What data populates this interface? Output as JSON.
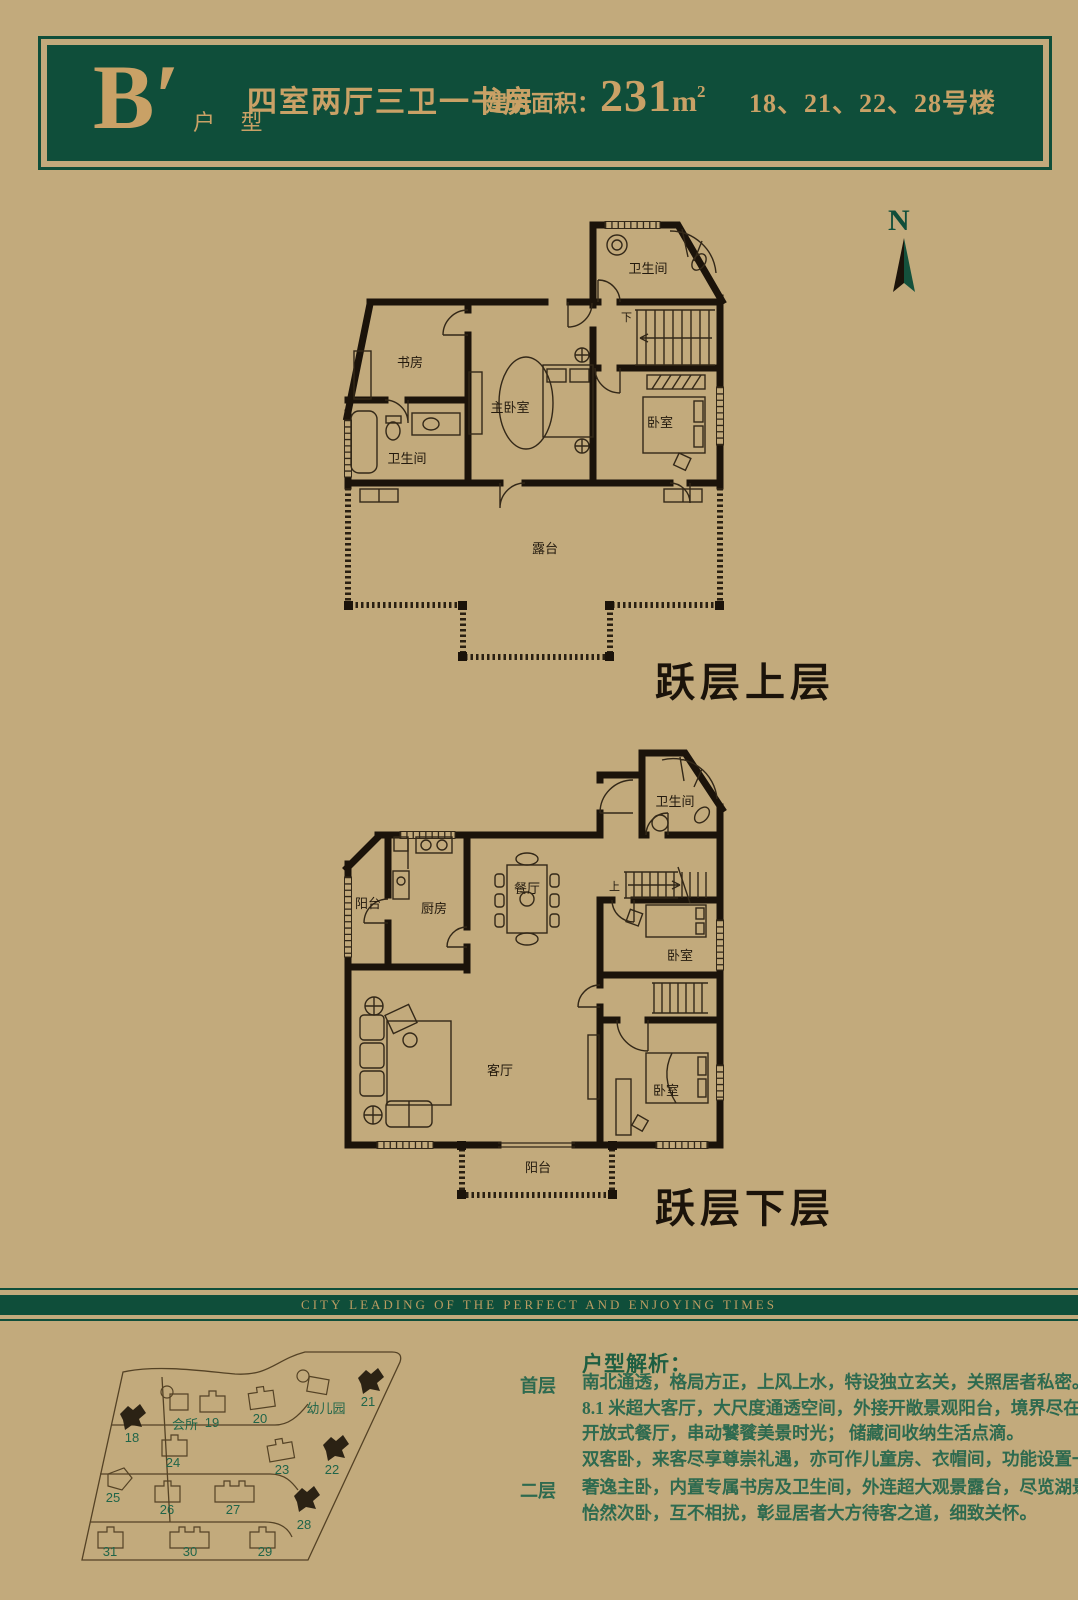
{
  "header": {
    "unit_letter": "B′",
    "unit_label": "户 型",
    "layout": "四室两厅三卫一书房",
    "area_label": "建筑面积：",
    "area_value": "231",
    "area_unit": "m",
    "area_sup": "2",
    "buildings": "18、21、22、28号楼"
  },
  "compass": {
    "label": "N"
  },
  "upper_plan": {
    "title": "跃层上层",
    "rooms": {
      "bath_top": "卫生间",
      "study": "书房",
      "master_bedroom": "主卧室",
      "bedroom": "卧室",
      "bath_lower": "卫生间",
      "terrace": "露台",
      "stair": "下"
    }
  },
  "lower_plan": {
    "title": "跃层下层",
    "rooms": {
      "bath": "卫生间",
      "balcony_side": "阳台",
      "kitchen": "厨房",
      "dining": "餐厅",
      "stair": "上",
      "bedroom_mid": "卧室",
      "living": "客厅",
      "bedroom_lower": "卧室",
      "balcony_bottom": "阳台"
    }
  },
  "banner": {
    "text": "CITY LEADING OF THE PERFECT AND ENJOYING TIMES"
  },
  "site_map": {
    "clubhouse": "会所",
    "kindergarten": "幼儿园",
    "buildings": [
      {
        "num": "18",
        "highlighted": true
      },
      {
        "num": "19",
        "highlighted": false
      },
      {
        "num": "20",
        "highlighted": false
      },
      {
        "num": "21",
        "highlighted": true
      },
      {
        "num": "22",
        "highlighted": true
      },
      {
        "num": "23",
        "highlighted": false
      },
      {
        "num": "24",
        "highlighted": false
      },
      {
        "num": "25",
        "highlighted": false
      },
      {
        "num": "26",
        "highlighted": false
      },
      {
        "num": "27",
        "highlighted": false
      },
      {
        "num": "28",
        "highlighted": true
      },
      {
        "num": "29",
        "highlighted": false
      },
      {
        "num": "30",
        "highlighted": false
      },
      {
        "num": "31",
        "highlighted": false
      }
    ]
  },
  "analysis": {
    "title": "户型解析：",
    "sections": [
      {
        "label": "首层",
        "lines": [
          "南北通透，格局方正，上风上水，特设独立玄关，关照居者私密。",
          "8.1 米超大客厅，大尺度通透空间，外接开敞景观阳台，境界尽在视野间。",
          "开放式餐厅，串动饕餮美景时光；  储藏间收纳生活点滴。",
          "双客卧，来客尽享尊崇礼遇，亦可作儿童房、衣帽间，功能设置一切随心。"
        ]
      },
      {
        "label": "二层",
        "lines": [
          "奢逸主卧，内置专属书房及卫生间，外连超大观景露台，尽览湖景，尊贵感浸润其中",
          "怡然次卧，互不相扰，彰显居者大方待客之道，细致关怀。"
        ]
      }
    ]
  }
}
